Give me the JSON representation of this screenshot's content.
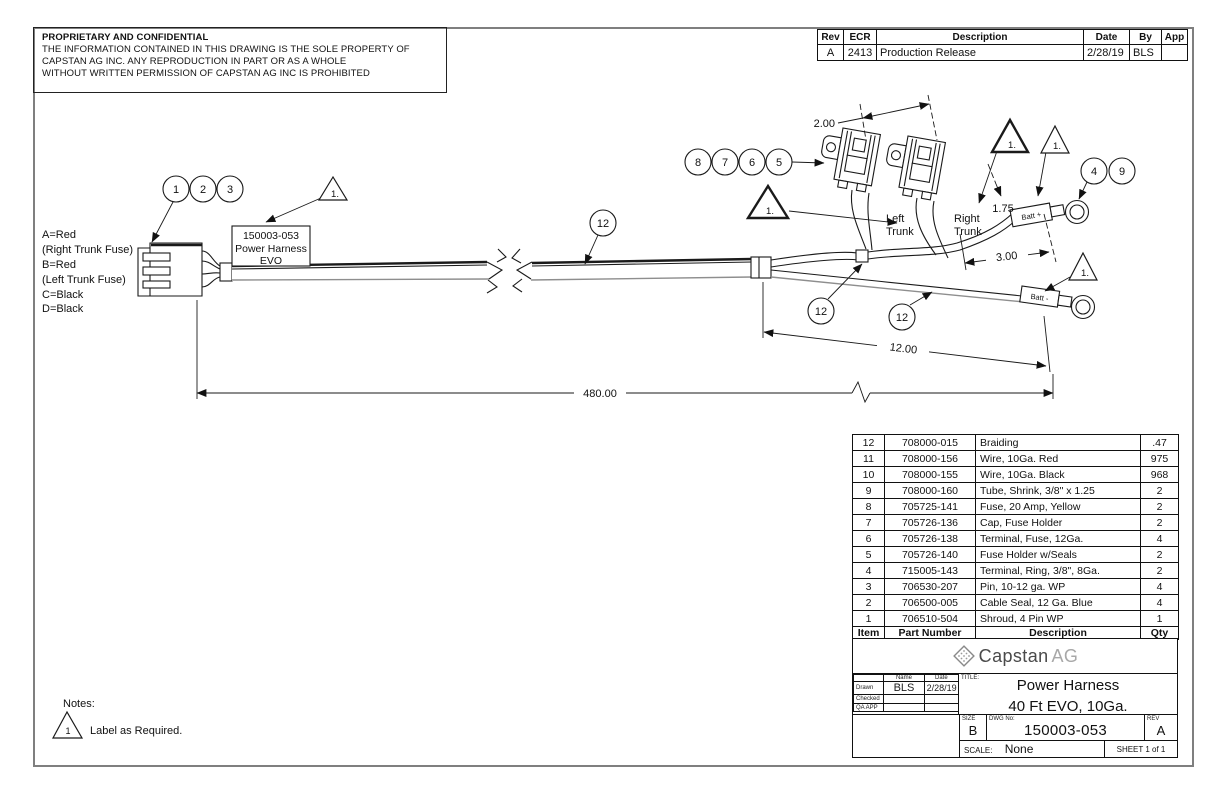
{
  "colors": {
    "line": "#1a1a1a",
    "frame": "#7f7f7f",
    "logo_dark": "#4a4a4a",
    "logo_light": "#a8a8a8",
    "wire_gray": "#8e8e8e"
  },
  "proprietary": {
    "title": "PROPRIETARY AND CONFIDENTIAL",
    "lines": [
      "THE INFORMATION CONTAINED IN THIS DRAWING IS THE SOLE PROPERTY OF",
      "CAPSTAN AG INC. ANY REPRODUCTION IN PART OR AS A WHOLE",
      "WITHOUT WRITTEN PERMISSION OF CAPSTAN AG INC IS PROHIBITED"
    ]
  },
  "revision": {
    "headers": [
      "Rev",
      "ECR",
      "Description",
      "Date",
      "By",
      "App"
    ],
    "rows": [
      {
        "rev": "A",
        "ecr": "2413",
        "description": "Production Release",
        "date": "2/28/19",
        "by": "BLS",
        "app": ""
      }
    ]
  },
  "drawing": {
    "pin_legend": [
      "A=Red",
      "(Right Trunk Fuse)",
      "B=Red",
      "(Left Trunk Fuse)",
      "C=Black",
      "D=Black"
    ],
    "harness_label": [
      "150003-053",
      "Power Harness",
      "EVO"
    ],
    "left_trunk": [
      "Left",
      "Trunk"
    ],
    "right_trunk": [
      "Right",
      "Trunk"
    ],
    "batt_plus": "Batt +",
    "batt_minus": "Batt -",
    "flag": "1.",
    "balloons": {
      "b1": "1",
      "b2": "2",
      "b3": "3",
      "b4": "4",
      "b5": "5",
      "b6": "6",
      "b7": "7",
      "b8": "8",
      "b9": "9",
      "b12": "12"
    },
    "dims": {
      "fuse_spacing": "2.00",
      "batt_lead": "1.75",
      "ring_lead": "3.00",
      "neg_lead": "12.00",
      "overall": "480.00"
    }
  },
  "bom": {
    "headers": [
      "Item",
      "Part Number",
      "Description",
      "Qty"
    ],
    "rows": [
      {
        "item": "12",
        "part": "708000-015",
        "desc": "Braiding",
        "qty": ".47"
      },
      {
        "item": "11",
        "part": "708000-156",
        "desc": "Wire, 10Ga. Red",
        "qty": "975"
      },
      {
        "item": "10",
        "part": "708000-155",
        "desc": "Wire, 10Ga. Black",
        "qty": "968"
      },
      {
        "item": "9",
        "part": "708000-160",
        "desc": "Tube, Shrink, 3/8\" x 1.25",
        "qty": "2"
      },
      {
        "item": "8",
        "part": "705725-141",
        "desc": "Fuse, 20 Amp, Yellow",
        "qty": "2"
      },
      {
        "item": "7",
        "part": "705726-136",
        "desc": "Cap, Fuse Holder",
        "qty": "2"
      },
      {
        "item": "6",
        "part": "705726-138",
        "desc": "Terminal, Fuse, 12Ga.",
        "qty": "4"
      },
      {
        "item": "5",
        "part": "705726-140",
        "desc": "Fuse Holder w/Seals",
        "qty": "2"
      },
      {
        "item": "4",
        "part": "715005-143",
        "desc": "Terminal, Ring, 3/8\", 8Ga.",
        "qty": "2"
      },
      {
        "item": "3",
        "part": "706530-207",
        "desc": "Pin, 10-12 ga. WP",
        "qty": "4"
      },
      {
        "item": "2",
        "part": "706500-005",
        "desc": "Cable Seal, 12 Ga. Blue",
        "qty": "4"
      },
      {
        "item": "1",
        "part": "706510-504",
        "desc": "Shroud, 4 Pin WP",
        "qty": "1"
      }
    ]
  },
  "title_block": {
    "logo_text": "Capstan",
    "logo_suffix": "AG",
    "sign": {
      "name_h": "Name",
      "date_h": "Date",
      "drawn_label": "Drawn",
      "drawn_name": "BLS",
      "drawn_date": "2/28/19",
      "checked_label": "Checked",
      "qa_label": "QA APP"
    },
    "title_caption": "TITLE:",
    "title_line1": "Power Harness",
    "title_line2": "40 Ft EVO, 10Ga.",
    "size_caption": "SIZE",
    "size": "B",
    "dwg_caption": "DWG No:",
    "dwg_no": "150003-053",
    "rev_caption": "REV",
    "rev": "A",
    "scale_caption": "SCALE:",
    "scale": "None",
    "sheet": "SHEET 1 of 1"
  },
  "notes": {
    "header": "Notes:",
    "flag": "1",
    "note": "Label as Required."
  }
}
